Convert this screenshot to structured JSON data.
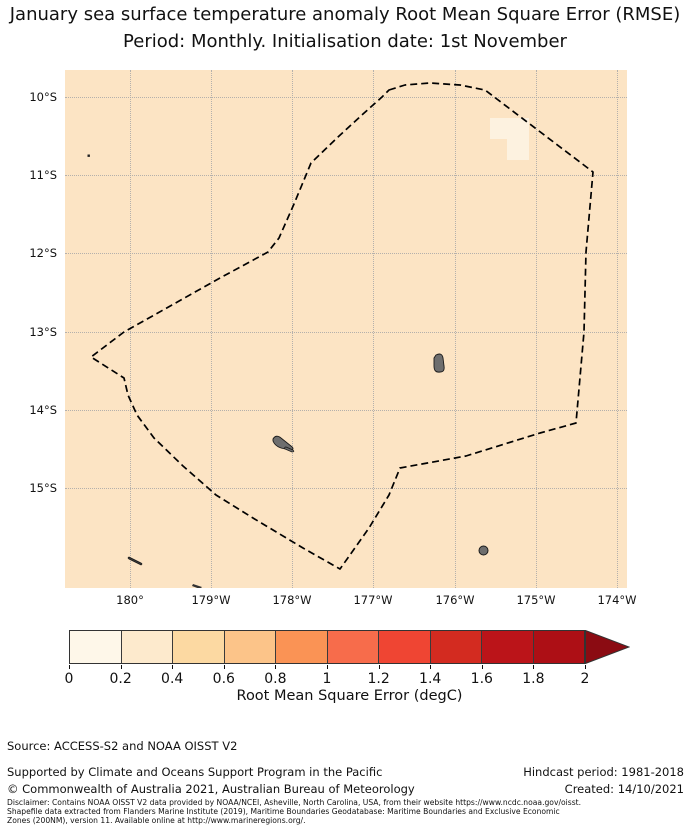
{
  "title": {
    "line1": "January sea surface temperature anomaly Root Mean Square Error (RMSE)",
    "line2": "Period: Monthly. Initialisation date: 1st November"
  },
  "map": {
    "x_ticks": [
      "180°",
      "179°W",
      "178°W",
      "177°W",
      "176°W",
      "175°W",
      "174°W"
    ],
    "y_ticks": [
      "10°S",
      "11°S",
      "12°S",
      "13°S",
      "14°S",
      "15°S"
    ],
    "ocean_fill": "#fce4c4",
    "low_rmse_patch_fill": "#fdf2e0",
    "boundary_style": "black dashed",
    "island_fill": "#6e6e6e"
  },
  "colorbar": {
    "label": "Root Mean Square Error (degC)",
    "tick_labels": [
      "0",
      "0.2",
      "0.4",
      "0.6",
      "0.8",
      "1",
      "1.2",
      "1.4",
      "1.6",
      "1.8",
      "2"
    ],
    "colors": [
      "#fef7e9",
      "#fdeacd",
      "#fcd9a2",
      "#fcc489",
      "#fa9355",
      "#f76c4b",
      "#ef4533",
      "#d32b20",
      "#bb1419",
      "#ad0f15"
    ],
    "arrow_color": "#8b0b12"
  },
  "footer": {
    "source": "Source: ACCESS-S2 and NOAA OISST V2",
    "supported": "Supported by Climate and Oceans Support Program in the Pacific",
    "copyright": "© Commonwealth of Australia 2021, Australian Bureau of Meteorology",
    "hindcast": "Hindcast period: 1981-2018",
    "created": "Created: 14/10/2021"
  },
  "disclaimer": {
    "line1": "Disclaimer: Contains NOAA OISST V2 data provided by NOAA/NCEI, Asheville, North Carolina, USA, from their website https://www.ncdc.noaa.gov/oisst.",
    "line2": "Shapefile data extracted from Flanders Marine Institute (2019), Maritime Boundaries Geodatabase: Maritime Boundaries and Exclusive Economic",
    "line3": "Zones (200NM), version 11. Available online at http://www.marineregions.org/."
  },
  "chart_data": {
    "type": "heatmap",
    "title": "January sea surface temperature anomaly Root Mean Square Error (RMSE)",
    "subtitle": "Period: Monthly. Initialisation date: 1st November",
    "x_tick_labels": [
      "180°",
      "179°W",
      "178°W",
      "177°W",
      "176°W",
      "175°W",
      "174°W"
    ],
    "y_tick_labels": [
      "10°S",
      "11°S",
      "12°S",
      "13°S",
      "14°S",
      "15°S"
    ],
    "lon_range_approx": [
      "179.2E",
      "173.9W"
    ],
    "lat_range_approx": [
      "9.6S",
      "16.3S"
    ],
    "grid": true,
    "colorbar": {
      "label": "Root Mean Square Error (degC)",
      "ticks": [
        0,
        0.2,
        0.4,
        0.6,
        0.8,
        1,
        1.2,
        1.4,
        1.6,
        1.8,
        2
      ],
      "range": [
        0,
        2
      ],
      "extend": "max",
      "bin_width": 0.2,
      "orientation": "horizontal"
    },
    "field_summary": [
      {
        "area": "entire mapped region",
        "rmse_degC_bin": "0.2-0.4"
      },
      {
        "area": "small L-shaped patch near 175.1W, 10.4S",
        "rmse_degC_bin": "0.0-0.2"
      }
    ],
    "overlays": [
      "dashed maritime boundary (EEZ) polygon",
      "small gray island landmasses",
      "dotted 1-degree graticule"
    ]
  }
}
